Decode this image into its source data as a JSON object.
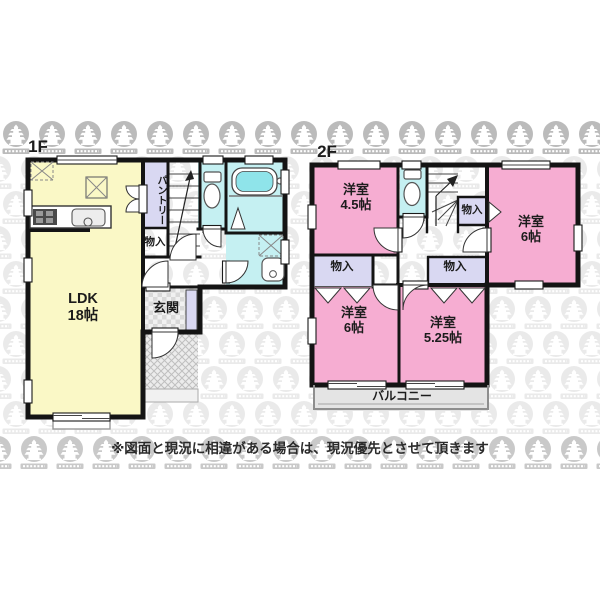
{
  "disclaimer": "※図面と現況に相違がある場合は、現況優先とさせて頂きます",
  "floor1": {
    "label": "1F",
    "ldk_name": "LDK",
    "ldk_size": "18帖",
    "pantry": "パントリー",
    "storage": "物入",
    "entrance": "玄関"
  },
  "floor2": {
    "label": "2F",
    "room_a_name": "洋室",
    "room_a_size": "4.5帖",
    "room_b_name": "洋室",
    "room_b_size": "6帖",
    "room_c_name": "洋室",
    "room_c_size": "6帖",
    "room_d_name": "洋室",
    "room_d_size": "5.25帖",
    "storage_hall": "物入",
    "storage_left": "物入",
    "storage_mid": "物入",
    "balcony": "バルコニー"
  },
  "colors": {
    "room_yellow": "#FAF8C6",
    "room_pink": "#F6ADD2",
    "room_cyan": "#C5F0F2",
    "closet_lavender": "#D9D8F2",
    "tub_water": "#8FE4EA",
    "balcony_gray": "#E4E4E4",
    "wall_black": "#141414",
    "watermark_gray": "#7a7a7a"
  }
}
